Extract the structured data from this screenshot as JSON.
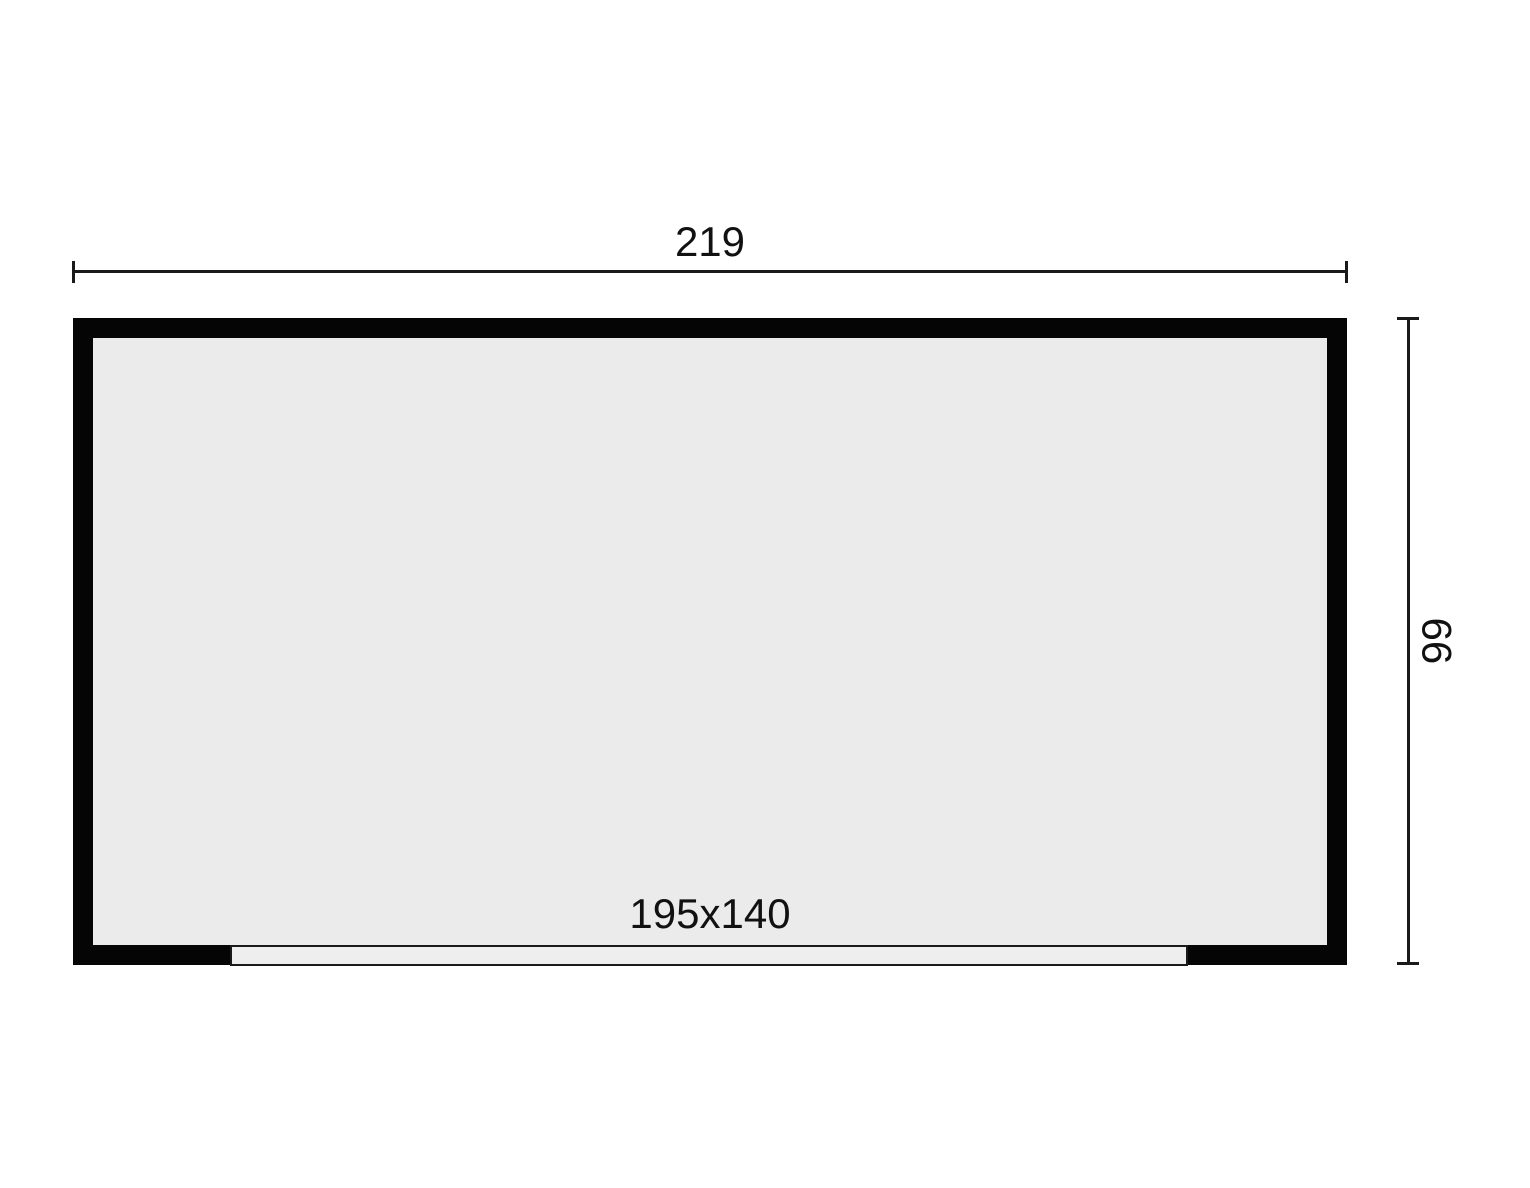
{
  "plan": {
    "outer_width_label": "219",
    "outer_depth_label": "99",
    "opening_label": "195x140"
  },
  "colors": {
    "wall": "#050505",
    "interior": "#ebebeb",
    "opening_fill": "#eeeeee",
    "dimension_line": "#1a1a1a",
    "text": "#111111"
  }
}
